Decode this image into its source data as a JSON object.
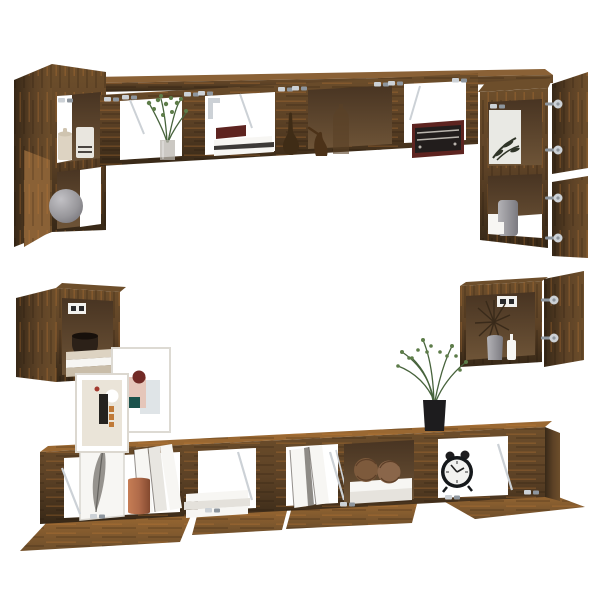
{
  "colors": {
    "bg": "#ffffff",
    "wood": "#5d4226",
    "woodDark": "#372817",
    "woodMid": "#6d4e2b",
    "woodLight": "#8a6136",
    "woodRust": "#9a6832",
    "inner": "#6e5437",
    "innerDark": "#483422",
    "chrome": "#ccd1d6",
    "chromeDark": "#8e969e",
    "cream": "#ddd3c2",
    "grayVase": "#97969a",
    "green": "#5d7c49",
    "greenDark": "#47633c",
    "copper": "#b06b4a",
    "maroon": "#5e2420",
    "black": "#1d1c1e",
    "wicker": "#7d5a3c",
    "pink": "#e5c6ba",
    "darkRed": "#722a26",
    "teal": "#1b524c",
    "orange": "#c07a38",
    "paleBlue": "#dfe4e7",
    "beige": "#eae4d8",
    "paper": "#f7f6f3",
    "feather": "#96938e"
  },
  "scene": {
    "background": "#ffffff",
    "furniture": [
      {
        "id": "top-left-cabinet",
        "decor": [
          "storage-jars",
          "sphere-vase",
          "open-door"
        ]
      },
      {
        "id": "top-wall-shelf",
        "decor": [
          "potted-plant",
          "book-stack-with-red-book",
          "wood-gourd",
          "wood-bird-figurine",
          "wood-vase",
          "vintage-radio",
          "flap-stays-hinges"
        ]
      },
      {
        "id": "top-right-cabinet",
        "decor": [
          "botanical-print",
          "gray-canister",
          "white-box",
          "open-doors-with-hinges"
        ]
      },
      {
        "id": "mid-left-wall-box",
        "decor": [
          "wall-mount-plate",
          "dark-bowl",
          "book-stack",
          "open-door"
        ]
      },
      {
        "id": "mid-right-wall-box",
        "decor": [
          "wall-mount-plate",
          "starburst-decor",
          "gray-vase",
          "white-bottle",
          "open-door-with-hinges"
        ]
      },
      {
        "id": "tv-stand",
        "decor": [
          "feather-print",
          "white-folders",
          "copper-vase",
          "flat-book-stack",
          "ring-binders",
          "wicker-balls-on-books",
          "alarm-clock",
          "open-drop-flaps",
          "chrome-stays"
        ]
      },
      {
        "id": "decor-on-stand",
        "decor": [
          "framed-abstract-print-large",
          "framed-abstract-print-small",
          "black-vase-with-green-branches"
        ]
      }
    ]
  }
}
